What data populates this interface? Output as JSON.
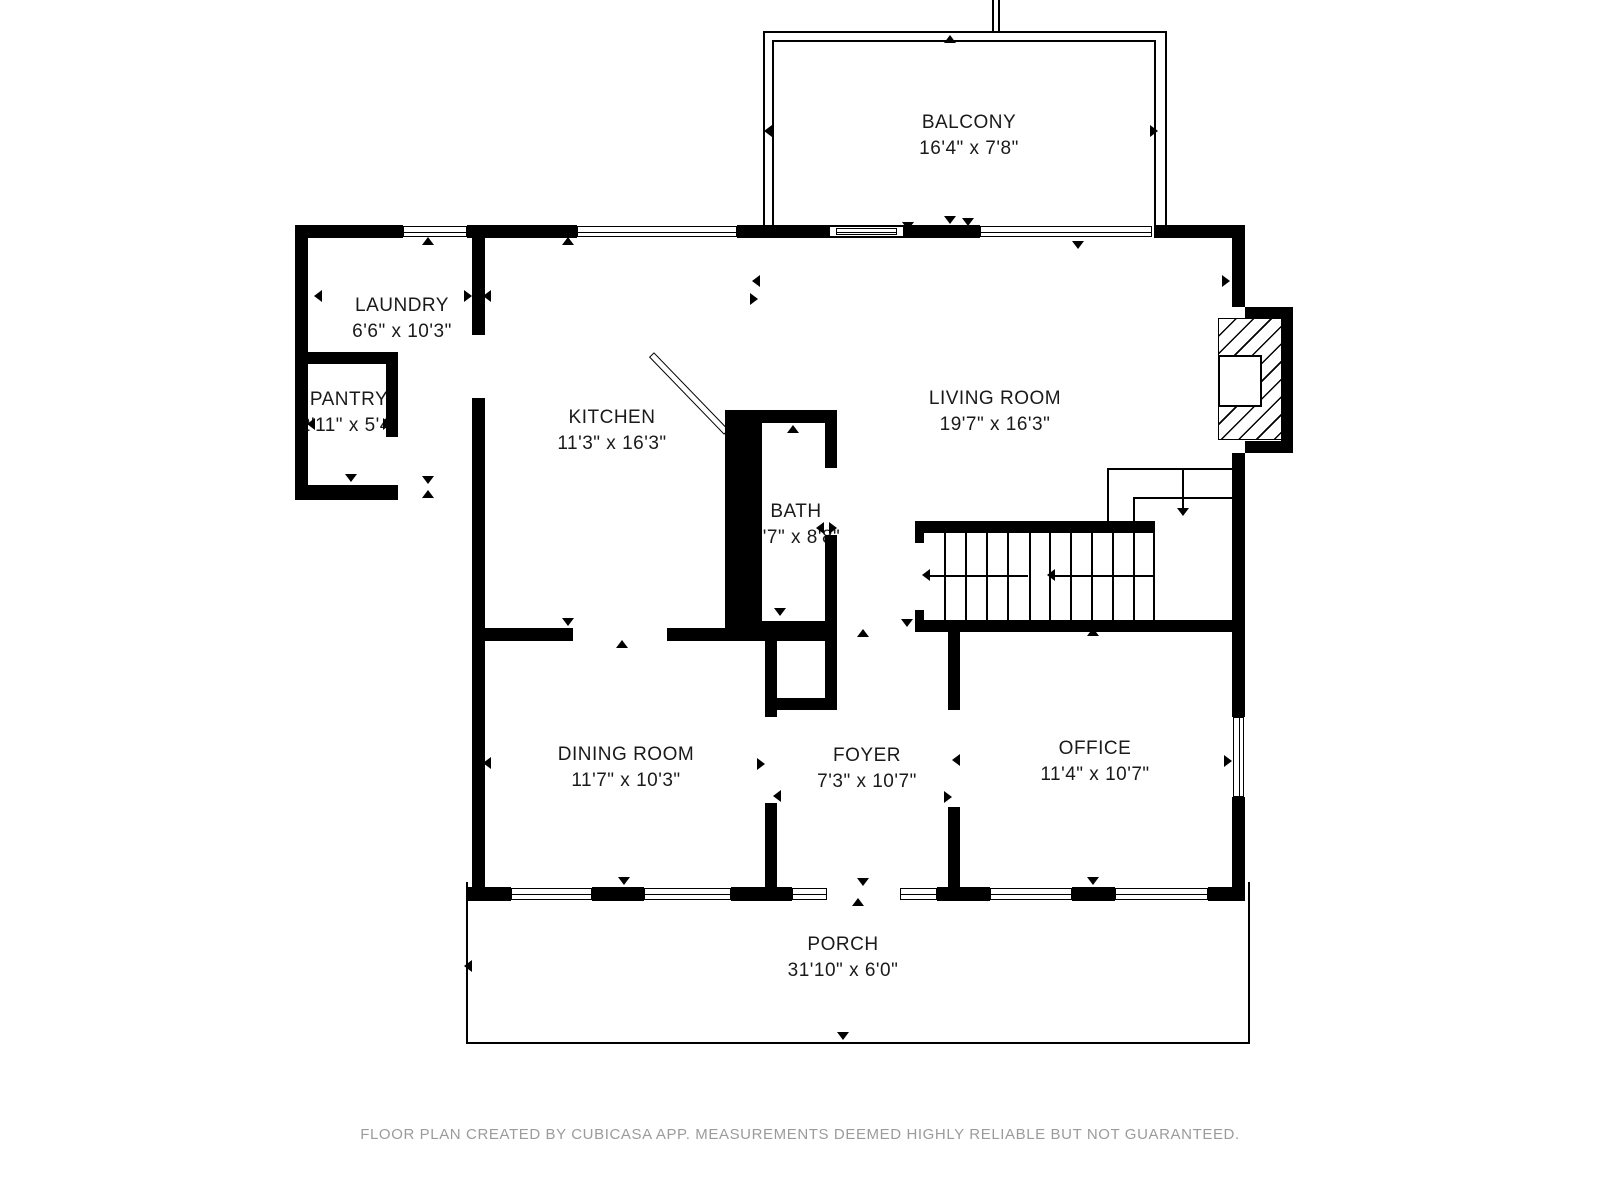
{
  "rooms": {
    "balcony": {
      "name": "BALCONY",
      "dims": "16'4\" x 7'8\""
    },
    "laundry": {
      "name": "LAUNDRY",
      "dims": "6'6\" x 10'3\""
    },
    "pantry": {
      "name": "PANTRY",
      "dims": "2'11\" x 5'4\""
    },
    "kitchen": {
      "name": "KITCHEN",
      "dims": "11'3\" x 16'3\""
    },
    "living_room": {
      "name": "LIVING ROOM",
      "dims": "19'7\" x 16'3\""
    },
    "bath": {
      "name": "BATH",
      "dims": "3'7\" x 8'8\""
    },
    "dining_room": {
      "name": "DINING ROOM",
      "dims": "11'7\" x 10'3\""
    },
    "foyer": {
      "name": "FOYER",
      "dims": "7'3\" x 10'7\""
    },
    "office": {
      "name": "OFFICE",
      "dims": "11'4\" x 10'7\""
    },
    "porch": {
      "name": "PORCH",
      "dims": "31'10\" x 6'0\""
    }
  },
  "footer": {
    "text": "FLOOR PLAN CREATED BY CUBICASA APP. MEASUREMENTS DEEMED HIGHLY RELIABLE BUT NOT GUARANTEED."
  },
  "colors": {
    "wall": "#000000",
    "text": "#1a1a1a",
    "footer_text": "#9b9b9b",
    "background": "#ffffff"
  },
  "plan": {
    "walls": [
      [
        295,
        225,
        108,
        13
      ],
      [
        467,
        225,
        110,
        13
      ],
      [
        737,
        225,
        93,
        13
      ],
      [
        903,
        225,
        77,
        13
      ],
      [
        1155,
        225,
        90,
        13
      ],
      [
        472,
        225,
        13,
        110
      ],
      [
        472,
        398,
        13,
        492
      ],
      [
        295,
        225,
        13,
        275
      ],
      [
        295,
        485,
        103,
        15
      ],
      [
        295,
        352,
        103,
        12
      ],
      [
        386,
        364,
        12,
        73
      ],
      [
        1232,
        238,
        13,
        69
      ],
      [
        1232,
        453,
        13,
        264
      ],
      [
        1232,
        797,
        13,
        90
      ],
      [
        1245,
        307,
        48,
        12
      ],
      [
        1281,
        307,
        12,
        146
      ],
      [
        1245,
        441,
        48,
        12
      ],
      [
        467,
        887,
        44,
        14
      ],
      [
        592,
        887,
        52,
        14
      ],
      [
        731,
        887,
        61,
        14
      ],
      [
        937,
        887,
        53,
        14
      ],
      [
        1072,
        887,
        43,
        14
      ],
      [
        1208,
        887,
        37,
        14
      ],
      [
        472,
        628,
        101,
        13
      ],
      [
        667,
        628,
        58,
        13
      ],
      [
        725,
        410,
        37,
        223
      ],
      [
        725,
        410,
        112,
        13
      ],
      [
        825,
        423,
        12,
        45
      ],
      [
        825,
        535,
        12,
        86
      ],
      [
        725,
        621,
        112,
        20
      ],
      [
        825,
        641,
        12,
        69
      ],
      [
        765,
        698,
        72,
        12
      ],
      [
        765,
        632,
        12,
        85
      ],
      [
        765,
        803,
        12,
        98
      ],
      [
        948,
        628,
        12,
        82
      ],
      [
        948,
        807,
        12,
        94
      ],
      [
        915,
        521,
        238,
        12
      ],
      [
        915,
        620,
        330,
        12
      ],
      [
        915,
        533,
        9,
        10
      ],
      [
        915,
        610,
        9,
        10
      ]
    ],
    "windows_h": [
      [
        403,
        226,
        64,
        11
      ],
      [
        577,
        226,
        160,
        11
      ],
      [
        980,
        226,
        172,
        11
      ],
      [
        511,
        888,
        81,
        12
      ],
      [
        644,
        888,
        87,
        12
      ],
      [
        792,
        888,
        35,
        12
      ],
      [
        900,
        888,
        37,
        12
      ],
      [
        990,
        888,
        82,
        12
      ],
      [
        1115,
        888,
        93,
        12
      ],
      [
        836,
        228,
        61,
        7
      ]
    ],
    "windows_v": [
      [
        1233,
        717,
        11,
        80
      ]
    ],
    "open_rects": [
      [
        830,
        225,
        73,
        13
      ]
    ],
    "lines": [
      [
        763,
        31,
        404,
        2
      ],
      [
        763,
        31,
        2,
        207
      ],
      [
        1165,
        31,
        2,
        207
      ],
      [
        772,
        40,
        384,
        2
      ],
      [
        772,
        40,
        2,
        198
      ],
      [
        1154,
        40,
        2,
        198
      ],
      [
        992,
        0,
        2,
        31
      ],
      [
        998,
        0,
        2,
        31
      ],
      [
        466,
        882,
        2,
        162
      ],
      [
        466,
        1042,
        784,
        2
      ],
      [
        1248,
        882,
        2,
        162
      ],
      [
        1107,
        468,
        126,
        2
      ],
      [
        1133,
        497,
        100,
        2
      ],
      [
        1107,
        468,
        2,
        55
      ],
      [
        1133,
        497,
        2,
        26
      ],
      [
        1153,
        521,
        2,
        99
      ],
      [
        1029,
        533,
        2,
        87
      ],
      [
        928,
        575,
        100,
        2
      ],
      [
        1053,
        575,
        100,
        2
      ],
      [
        1182,
        470,
        2,
        40
      ],
      [
        830,
        225,
        73,
        2
      ],
      [
        830,
        236,
        73,
        2
      ]
    ],
    "tread_xs": [
      944,
      965,
      986,
      1007,
      1049,
      1070,
      1091,
      1112,
      1133
    ],
    "tread_y": 533,
    "tread_h": 87,
    "arrows": [
      [
        950,
        41,
        "up"
      ],
      [
        770,
        131,
        "left"
      ],
      [
        1156,
        131,
        "right"
      ],
      [
        950,
        222,
        "down"
      ],
      [
        908,
        228,
        "down"
      ],
      [
        968,
        224,
        "down"
      ],
      [
        428,
        243,
        "up"
      ],
      [
        568,
        243,
        "up"
      ],
      [
        1078,
        247,
        "down"
      ],
      [
        320,
        296,
        "left"
      ],
      [
        470,
        296,
        "right"
      ],
      [
        489,
        296,
        "left"
      ],
      [
        353,
        360,
        "up"
      ],
      [
        313,
        424,
        "left"
      ],
      [
        389,
        424,
        "right"
      ],
      [
        351,
        480,
        "down"
      ],
      [
        428,
        482,
        "down"
      ],
      [
        428,
        496,
        "up"
      ],
      [
        758,
        281,
        "left"
      ],
      [
        756,
        299,
        "right"
      ],
      [
        793,
        431,
        "up"
      ],
      [
        822,
        528,
        "left"
      ],
      [
        835,
        528,
        "right"
      ],
      [
        780,
        614,
        "down"
      ],
      [
        795,
        628,
        "down"
      ],
      [
        907,
        625,
        "down"
      ],
      [
        1228,
        281,
        "right"
      ],
      [
        928,
        575,
        "left"
      ],
      [
        1053,
        575,
        "left"
      ],
      [
        1183,
        514,
        "down"
      ],
      [
        568,
        624,
        "down"
      ],
      [
        622,
        646,
        "up"
      ],
      [
        863,
        635,
        "up"
      ],
      [
        1093,
        634,
        "up"
      ],
      [
        489,
        763,
        "left"
      ],
      [
        763,
        764,
        "right"
      ],
      [
        779,
        796,
        "left"
      ],
      [
        958,
        760,
        "left"
      ],
      [
        950,
        797,
        "right"
      ],
      [
        1230,
        761,
        "right"
      ],
      [
        624,
        883,
        "down"
      ],
      [
        863,
        884,
        "down"
      ],
      [
        1093,
        883,
        "down"
      ],
      [
        858,
        904,
        "up"
      ],
      [
        470,
        966,
        "left"
      ],
      [
        843,
        1038,
        "down"
      ]
    ]
  }
}
